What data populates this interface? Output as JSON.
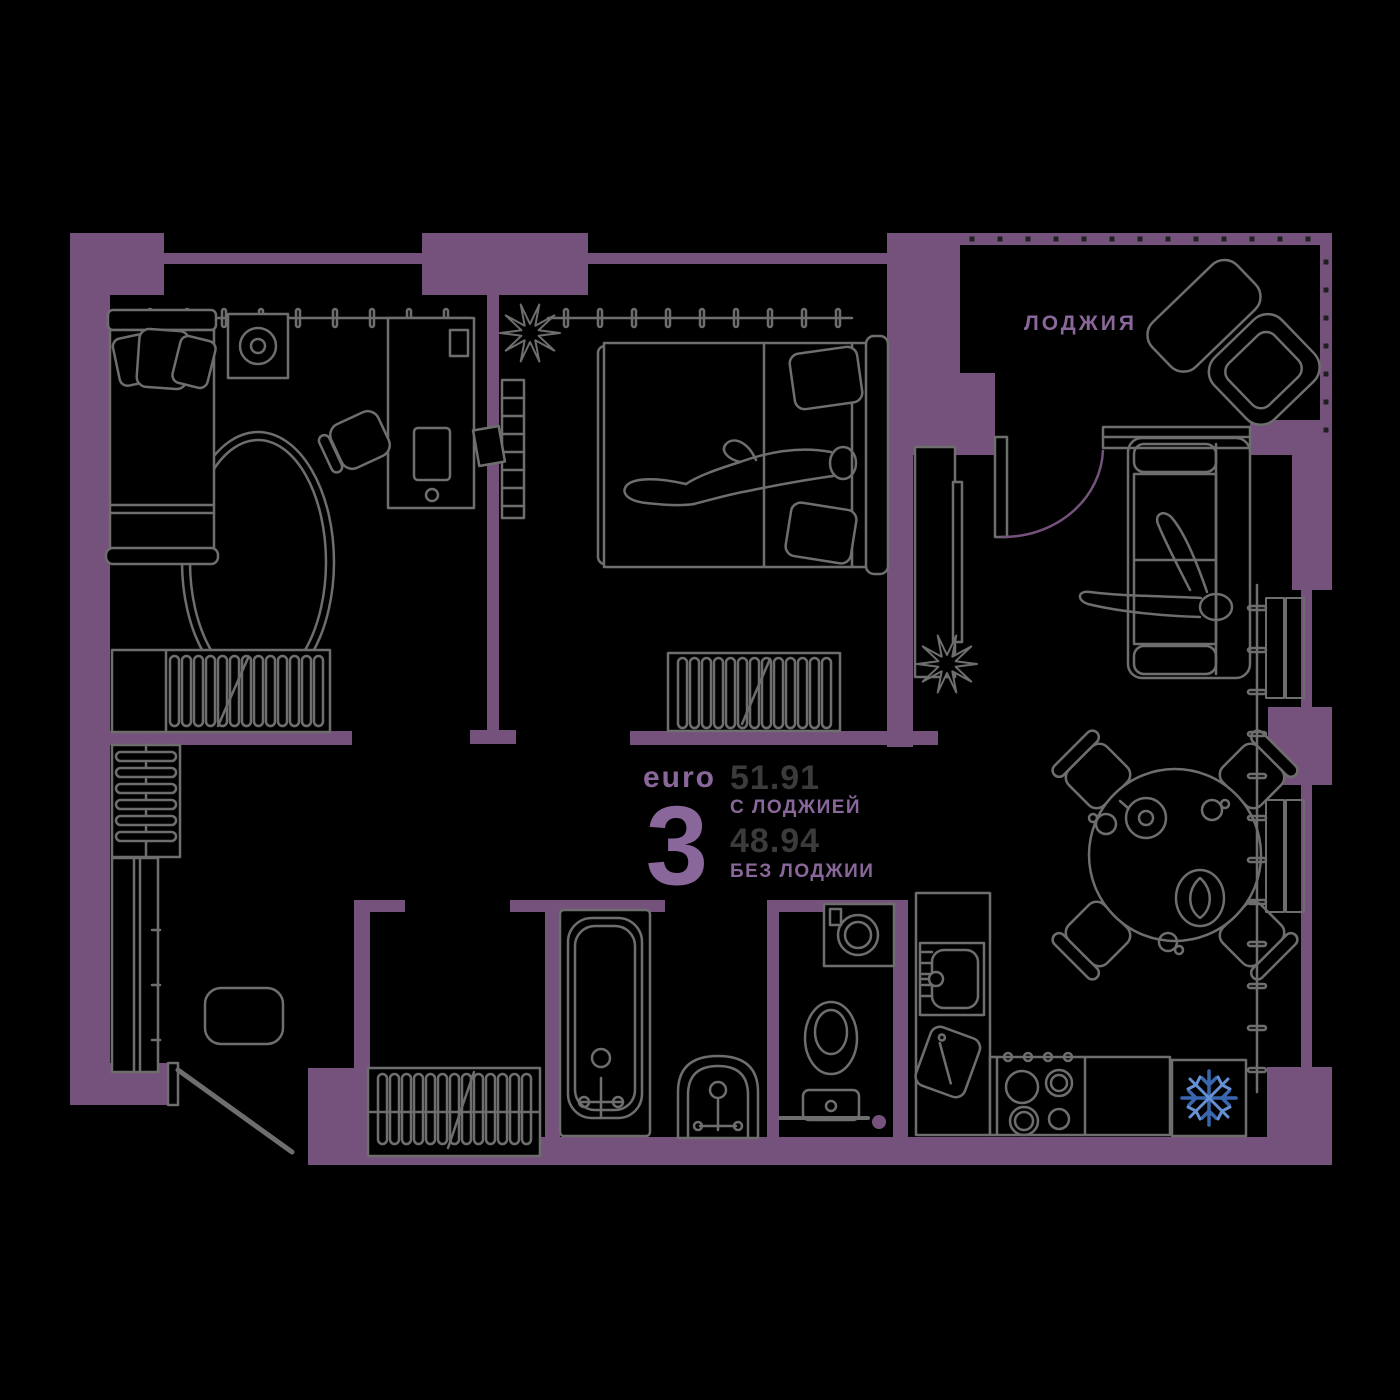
{
  "plan": {
    "type_label": "euro",
    "rooms_count": "3",
    "area_with_loggia": "51.91",
    "area_with_loggia_caption": "С ЛОДЖИЕЙ",
    "area_without_loggia": "48.94",
    "area_without_loggia_caption": "БЕЗ ЛОДЖИИ"
  },
  "loggia": {
    "label": "ЛОДЖИЯ"
  },
  "icons": {
    "fridge_badge": "snowflake-icon"
  },
  "colors": {
    "background": "#000000",
    "wall": "#75527C",
    "furniture_line": "#6E6E6E",
    "accent_text": "#8A679A",
    "area_value_text": "#3B3B3B",
    "loggia_tick": "#1F1F1F",
    "snowflake_primary": "#3A66B0",
    "snowflake_secondary": "#6591D3"
  }
}
